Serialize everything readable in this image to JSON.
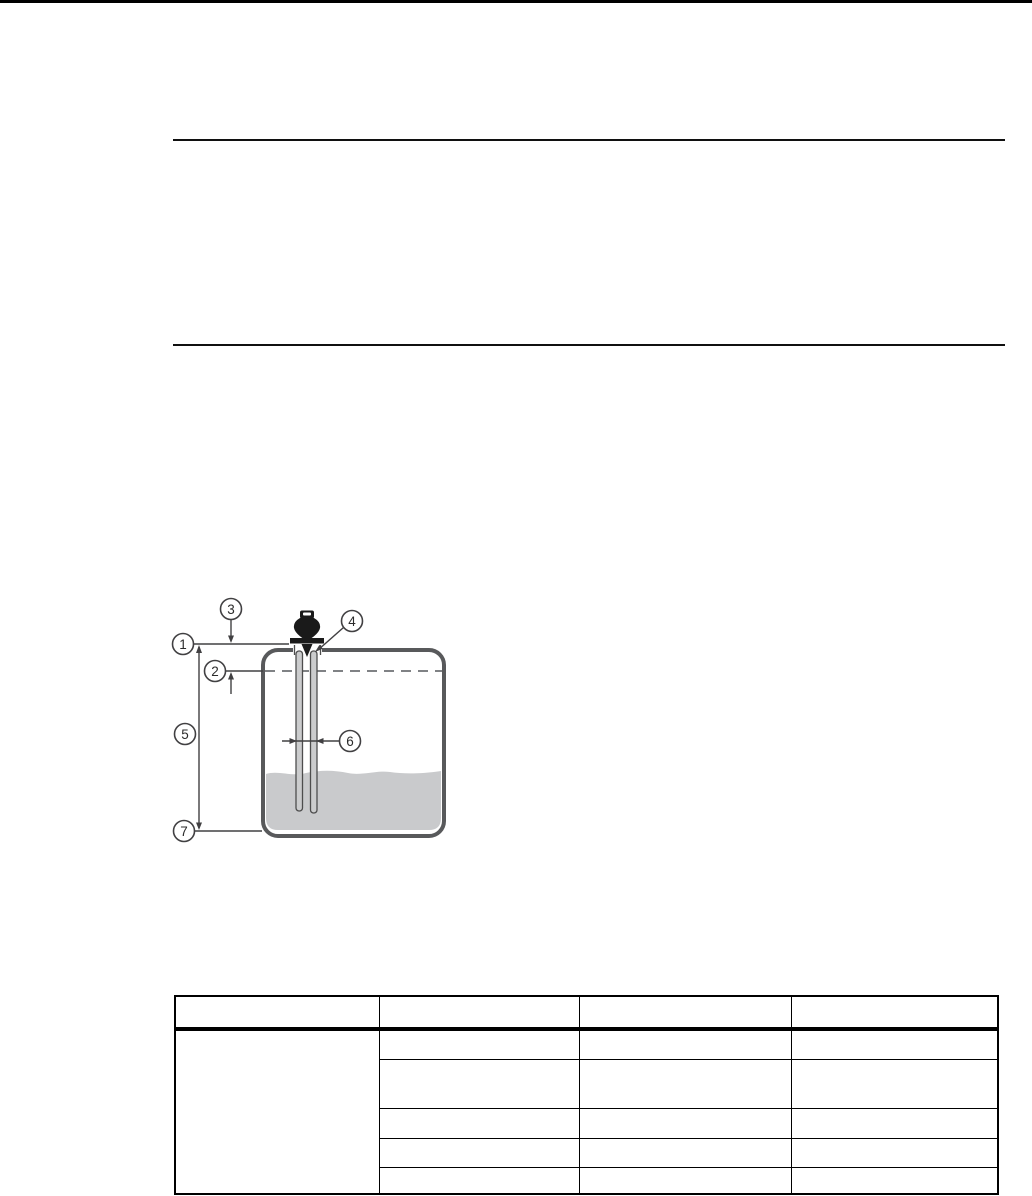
{
  "diagram": {
    "title_note": "",
    "callouts": [
      "1",
      "2",
      "3",
      "4",
      "5",
      "6",
      "7"
    ],
    "colors": {
      "tank_outline": "#58595b",
      "liquid_fill": "#c9cacc",
      "instrument_body": "#1a1a1a",
      "dimension_line": "#414042",
      "dashed_level_line": "#808285"
    }
  },
  "table": {
    "headers": [
      "",
      "",
      "",
      ""
    ],
    "col1_merged": "",
    "rows": [
      [
        "",
        "",
        ""
      ],
      [
        "",
        "",
        ""
      ],
      [
        "",
        "",
        ""
      ],
      [
        "",
        "",
        ""
      ],
      [
        "",
        "",
        ""
      ]
    ]
  }
}
